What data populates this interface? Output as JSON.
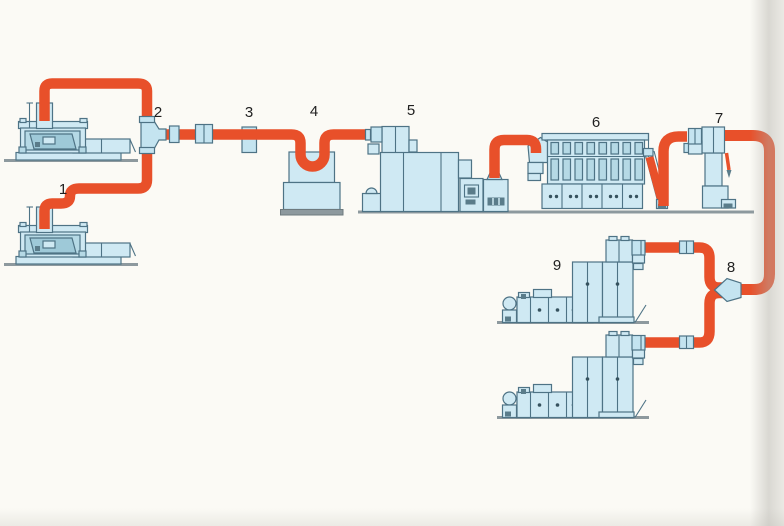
{
  "diagram": {
    "title": "",
    "labels": {
      "n1": "1",
      "n2": "2",
      "n3": "3",
      "n4": "4",
      "n5": "5",
      "n6": "6",
      "n7": "7",
      "n8": "8",
      "n9": "9"
    }
  },
  "colors": {
    "pipe": "#e8502a",
    "machine_fill": "#cfe9f3",
    "machine_fill_mid": "#b5d9e5",
    "machine_accent_dark": "#5a7c8a",
    "outline": "#4e7385",
    "ground": "#8d999e",
    "background": "#fbfaf5",
    "label_text": "#1f1f1f"
  }
}
